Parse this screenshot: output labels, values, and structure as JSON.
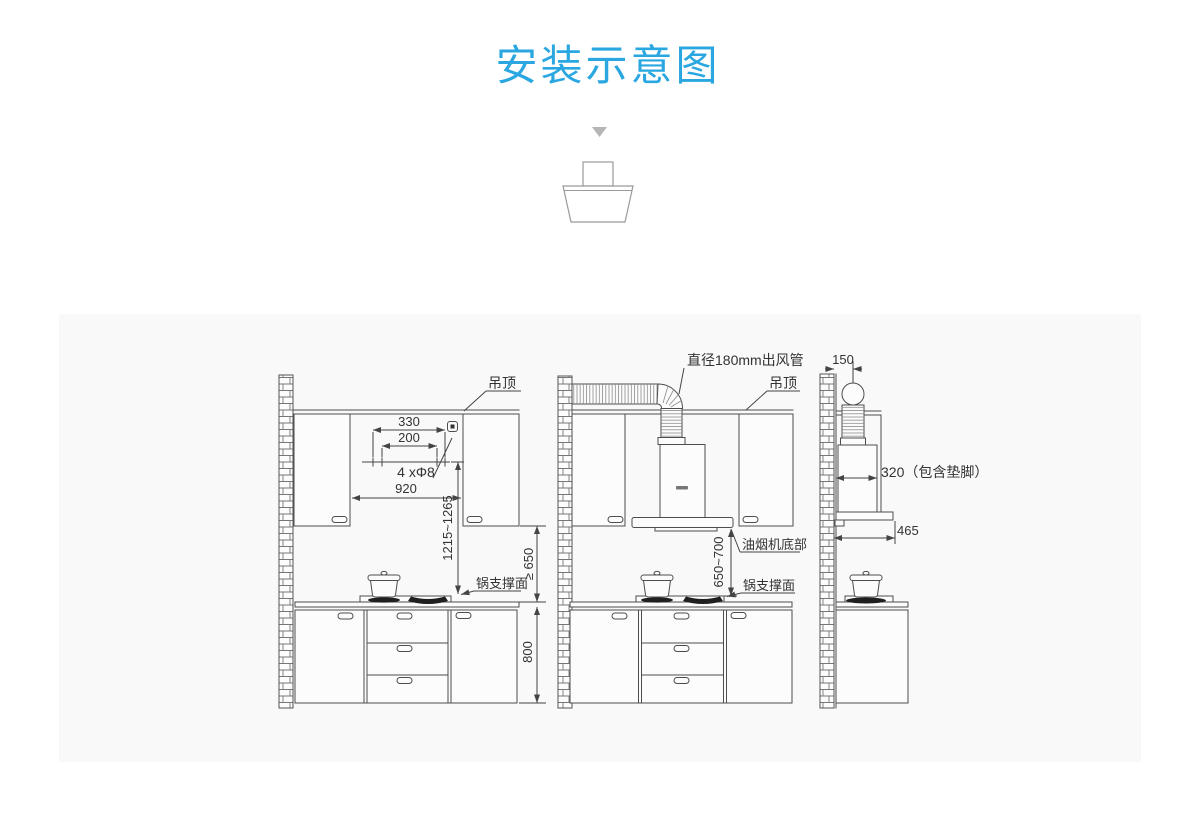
{
  "title": "安装示意图",
  "colors": {
    "accent_blue": "#2aa7e0",
    "panel_bg": "#f9f9f9",
    "line_color": "#4d4d4d",
    "text_color": "#333333"
  },
  "front_view": {
    "ceiling_label": "吊顶",
    "dim_330": "330",
    "dim_200": "200",
    "holes_label": "4 xΦ8",
    "dim_920": "920",
    "dim_height_range": "1215~1265",
    "pot_surface_label": "锅支撑面",
    "dim_min_height": "≥ 650",
    "dim_counter_height": "800"
  },
  "duct_view": {
    "duct_label": "直径180mm出风管",
    "ceiling_label": "吊顶",
    "hood_bottom_label": "油烟机底部",
    "dim_height_range": "650~700",
    "pot_surface_label": "锅支撑面"
  },
  "side_view": {
    "dim_150": "150",
    "depth_label": "320（包含垫脚）",
    "dim_465": "465"
  }
}
